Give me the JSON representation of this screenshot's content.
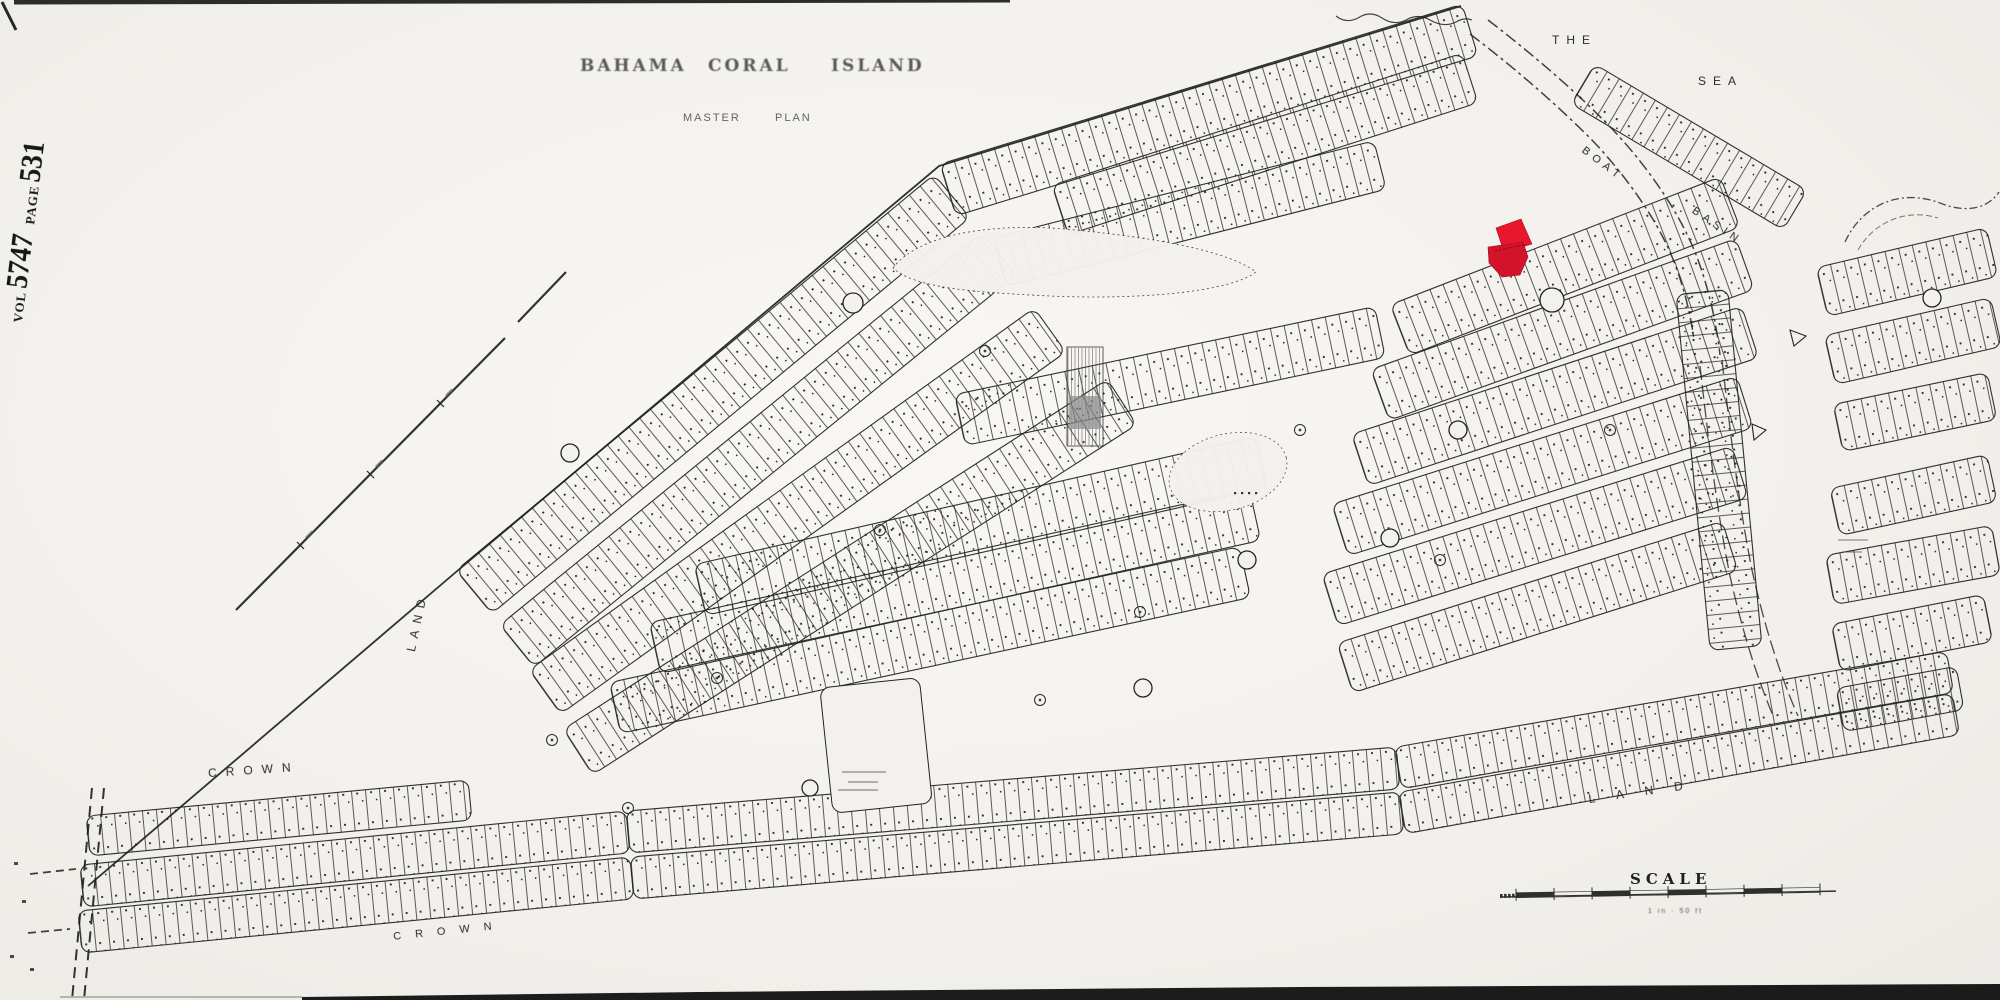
{
  "stamp": {
    "vol_label": "VOL",
    "volume": "5747",
    "page_label": "PAGE",
    "page": "531"
  },
  "title": {
    "word1": "BAHAMA",
    "word2": "CORAL",
    "word3": "ISLAND",
    "sub1": "MASTER",
    "sub2": "PLAN"
  },
  "labels": {
    "the": "THE",
    "sea": "SEA",
    "boat": "BOAT",
    "basin": "BASIN",
    "crown_west": "CROWN",
    "land_west": "LAND",
    "crown_south": "CROWN",
    "land_southeast": "LAND",
    "scale_title": "SCALE",
    "scale_ratio": "1 in · 50 ft"
  },
  "highlight": {
    "parcel_color": "#e8172c",
    "parcel_color_dark": "#d31329"
  },
  "colors": {
    "paper": "#f3f1ed",
    "ink": "#1f1f1f",
    "faded_title": "#595959",
    "shade_gray": "#8a8a8a"
  }
}
